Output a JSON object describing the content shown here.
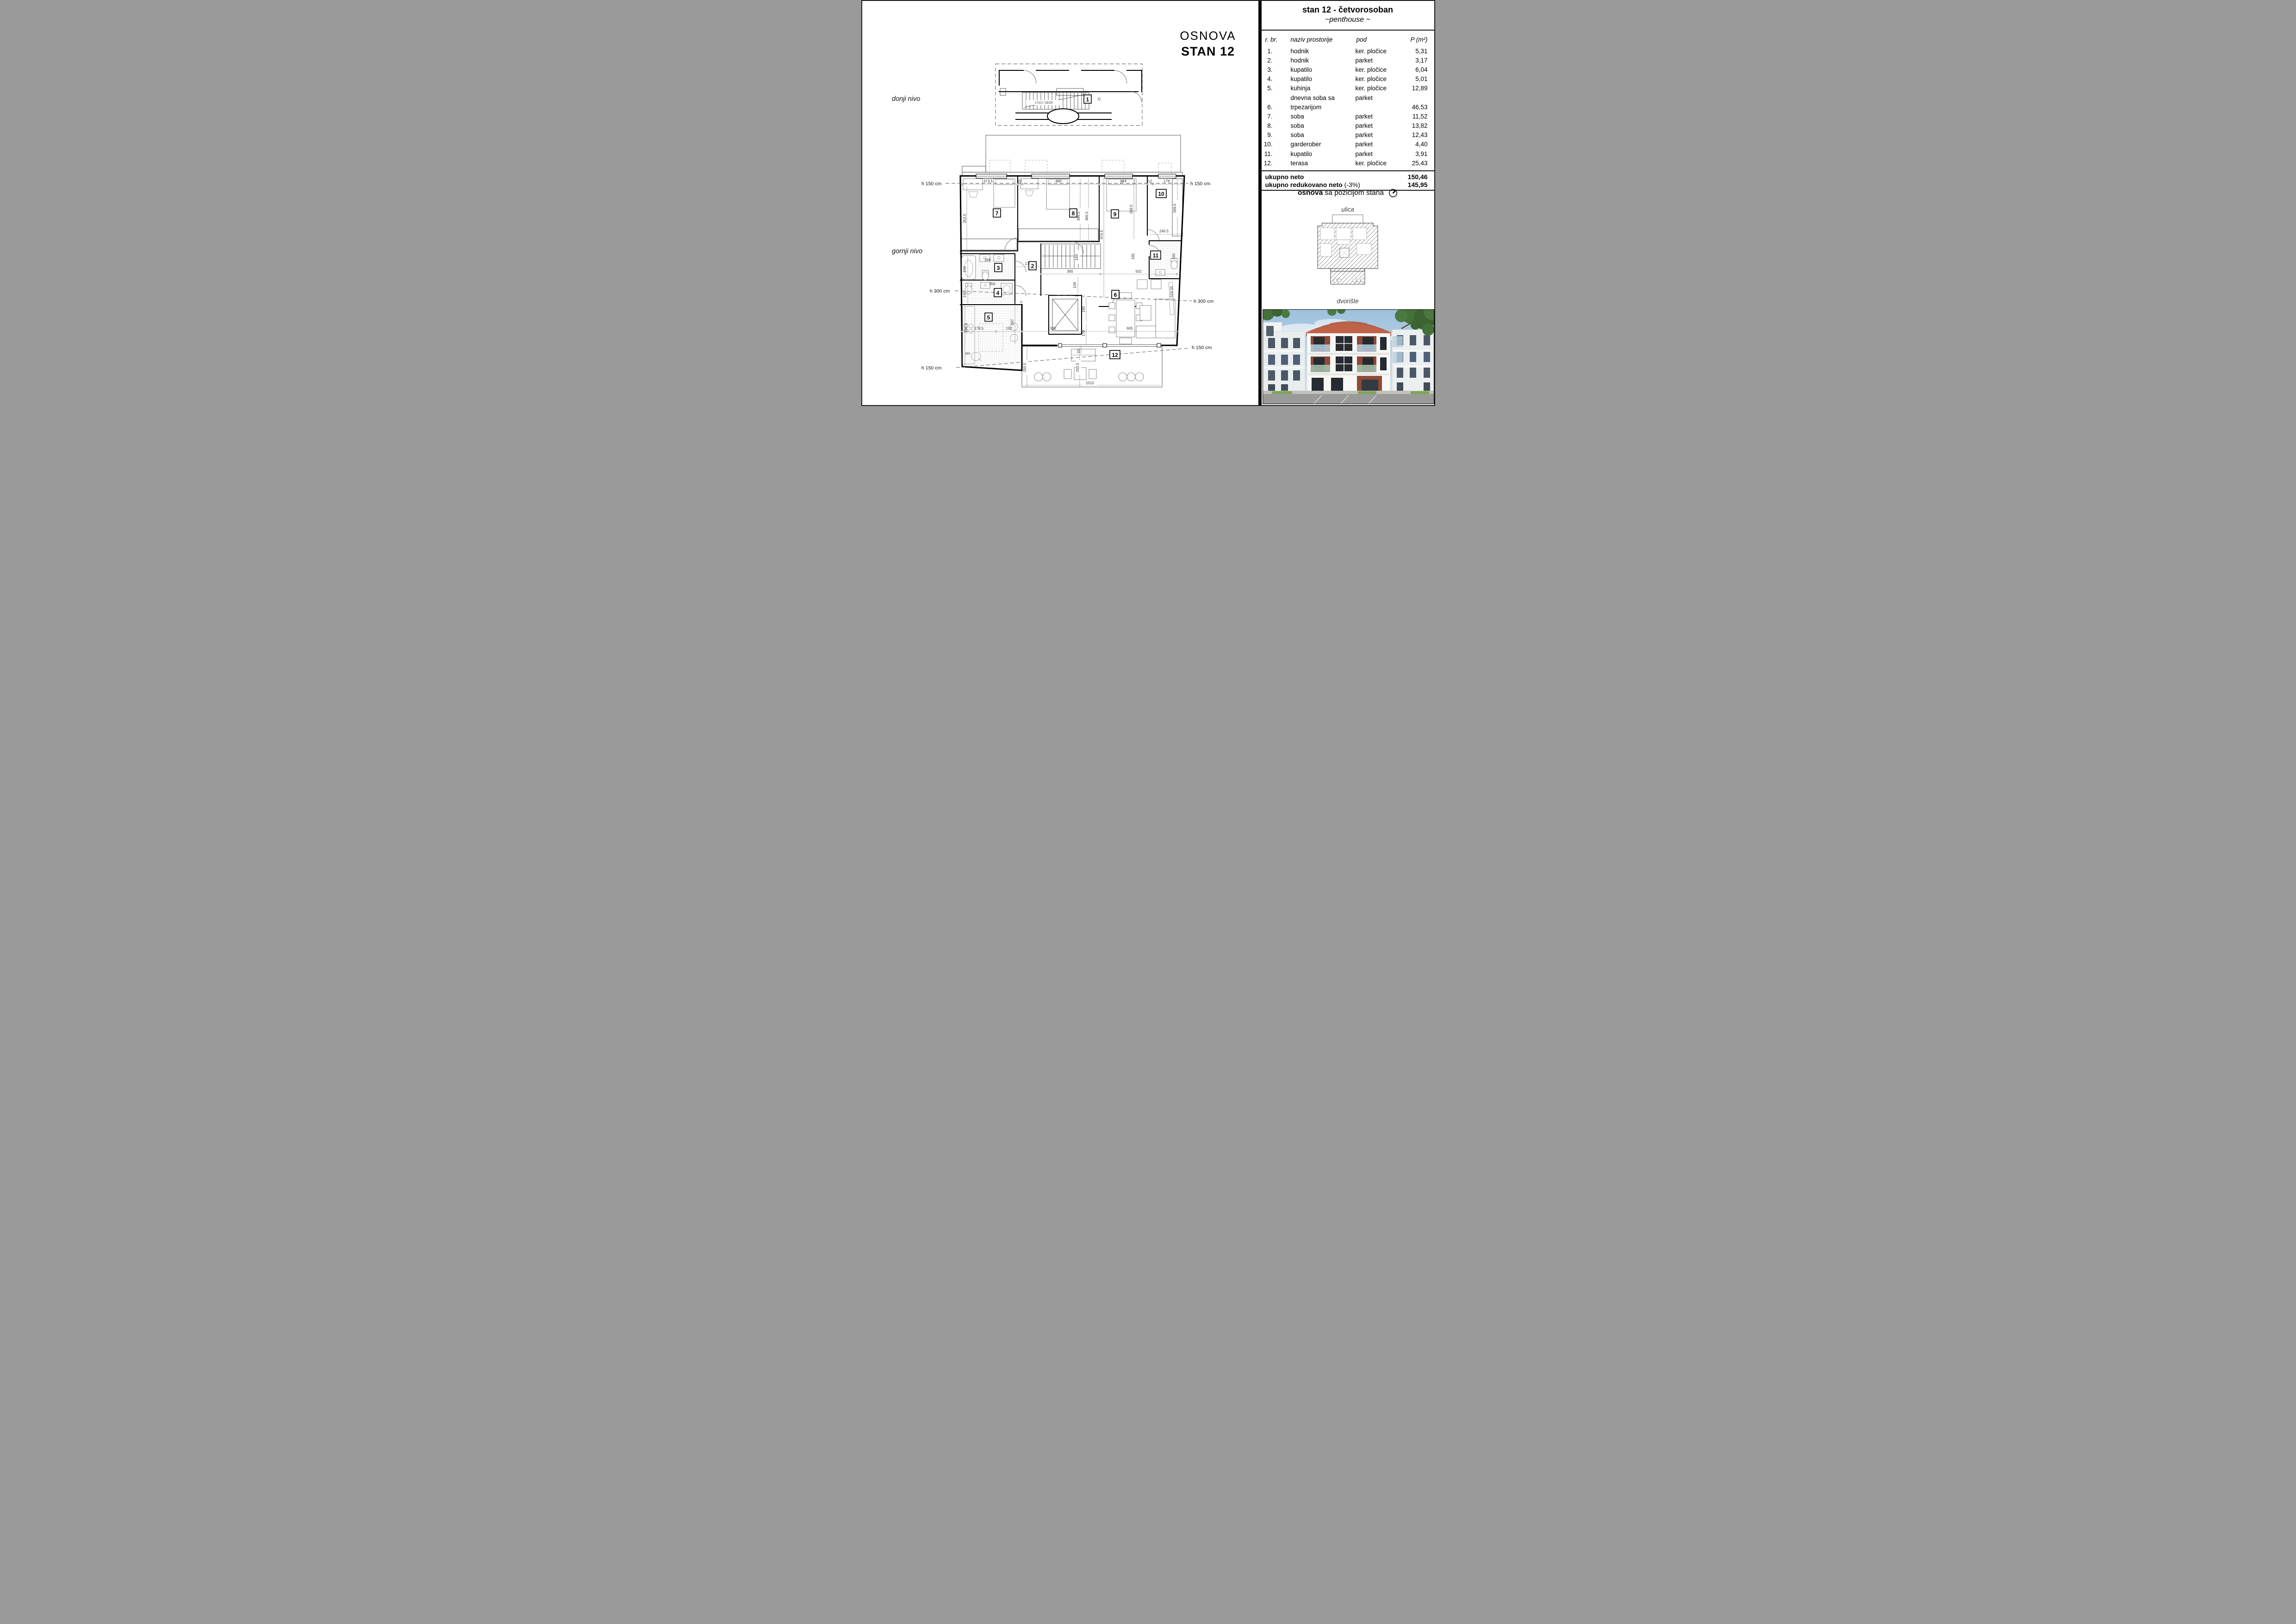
{
  "plan": {
    "title1": "OSNOVA",
    "title2": "STAN 12",
    "level_lower": "donji nivo",
    "level_upper": "gornji nivo",
    "rooms": [
      "1",
      "2",
      "3",
      "4",
      "5",
      "6",
      "7",
      "8",
      "9",
      "10",
      "11",
      "12"
    ],
    "h": [
      "h 150 cm",
      "h 300 cm"
    ],
    "dims": {
      "top": [
        "373.5",
        "20",
        "480",
        "344",
        "12",
        "178"
      ],
      "rot_upper": [
        "353.5",
        "366.5",
        "366.5",
        "289.5",
        "474.5",
        "289.5"
      ],
      "right": [
        "246.5",
        "160",
        "185"
      ],
      "mid": [
        "135",
        "350",
        "349",
        "365",
        "502",
        "108",
        "184"
      ],
      "rot_lower": [
        "169",
        "140",
        "405.5",
        "297",
        "180",
        "170",
        "524.55"
      ],
      "bottom": [
        "178.5",
        "192",
        "386",
        "605",
        "1015"
      ],
      "terrace": [
        "250.5",
        "250.5",
        "33"
      ],
      "stair": "17x17.18/29",
      "letters": [
        "F",
        "MS"
      ]
    }
  },
  "panel": {
    "title": "stan 12 - četvorosoban",
    "subtitle": "~penthouse ~",
    "columns": {
      "num": "r. br.",
      "name": "naziv prostorije",
      "pod": "pod",
      "area": "P (m²)"
    },
    "rows": [
      {
        "num": "1.",
        "name": "hodnik",
        "pod": "ker. pločice",
        "area": "5,31"
      },
      {
        "num": "2.",
        "name": "hodnik",
        "pod": "parket",
        "area": "3,17"
      },
      {
        "num": "3.",
        "name": "kupatilo",
        "pod": "ker. pločice",
        "area": "6,04"
      },
      {
        "num": "4.",
        "name": "kupatilo",
        "pod": "ker. pločice",
        "area": "5,01"
      },
      {
        "num": "5.",
        "name": "kuhinja",
        "pod": "ker. pločice",
        "area": "12,89"
      },
      {
        "num": "",
        "name": "dnevna soba sa",
        "pod": "parket",
        "area": ""
      },
      {
        "num": "6.",
        "name": "trpezarijom",
        "pod": "",
        "area": "46,53"
      },
      {
        "num": "7.",
        "name": "soba",
        "pod": "parket",
        "area": "11,52"
      },
      {
        "num": "8.",
        "name": "soba",
        "pod": "parket",
        "area": "13,82"
      },
      {
        "num": "9.",
        "name": "soba",
        "pod": "parket",
        "area": "12,43"
      },
      {
        "num": "10.",
        "name": "garderober",
        "pod": "parket",
        "area": "4,40"
      },
      {
        "num": "11.",
        "name": "kupatilo",
        "pod": "parket",
        "area": "3,91"
      },
      {
        "num": "12.",
        "name": "terasa",
        "pod": "ker. pločice",
        "area": "25,43"
      }
    ],
    "totals": {
      "neto_label": "ukupno neto",
      "neto_value": "150,46",
      "reduced_label": "ukupno redukovano neto",
      "reduced_note": "(-3%)",
      "reduced_value": "145,95"
    },
    "site": {
      "title_bold": "osnova",
      "title_rest": "sa pozicijom stana",
      "street": "ulica",
      "yard": "dvorište"
    }
  },
  "colors": {
    "line": "#000000",
    "dim_text": "#3a3a3a",
    "roof_render": "#bf6348",
    "loggia_accent": "#8e4a36",
    "sky": "#a7c7e0",
    "foliage": "#44703a",
    "road": "#9a9a98"
  }
}
